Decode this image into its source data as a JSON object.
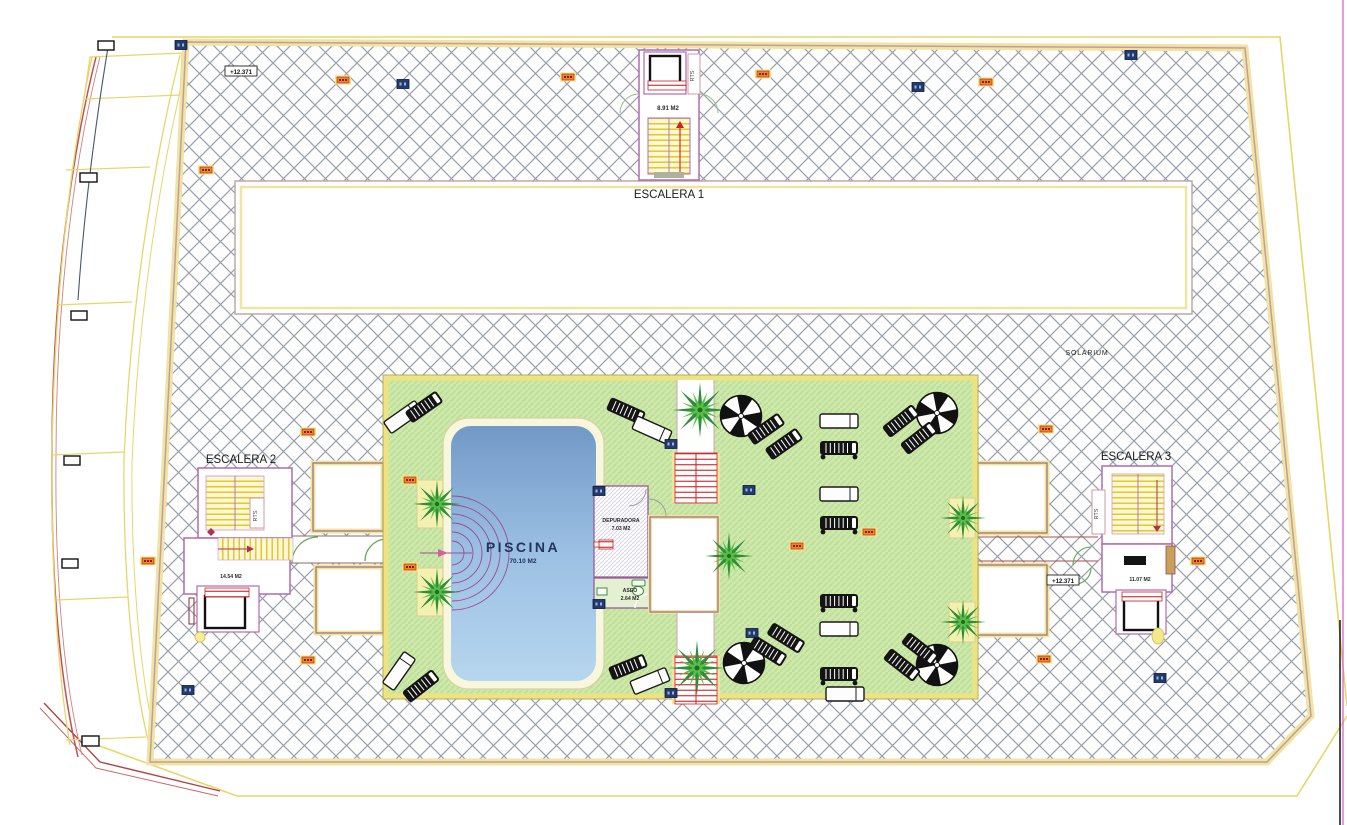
{
  "drawing": {
    "stairwells": {
      "escalera1": {
        "label": "ESCALERA 1",
        "area": "8.91 M2",
        "riser_label": "RTS"
      },
      "escalera2": {
        "label": "ESCALERA 2",
        "area": "14.54 M2",
        "riser_label": "RTS"
      },
      "escalera3": {
        "label": "ESCALERA 3",
        "area": "11.07 M2",
        "riser_label": "RTS"
      }
    },
    "areas": {
      "solarium_label": "SOLARIUM",
      "piscina": {
        "label": "PISCINA",
        "area": "70.10 M2"
      },
      "depuradora": {
        "label": "DEPURADORA",
        "area": "7.03 M2"
      },
      "aseo": {
        "label": "ASEO",
        "area": "2.64 M2"
      }
    },
    "markers": {
      "elevation": "+12.371"
    },
    "colors": {
      "hatch_line": "#99a0aa",
      "boundary_yellow": "#efe5a0",
      "facade_yellow": "#e6d66a",
      "outline_pink": "#c49ba5",
      "wall_purple": "#b06cb0",
      "terrace_green": "#cfe8ad",
      "terrace_hatch": "#bcdf96",
      "pool_blue_top": "#7299c7",
      "pool_blue_bottom": "#b7d6ee",
      "steps_purple": "#9a4a92",
      "stair_yellow": "#e3ca32",
      "accent_red": "#cc2222",
      "tag_orange": "#ee8822",
      "tag_blue": "#223a6e",
      "sheet_magenta": "#d957c9"
    }
  }
}
